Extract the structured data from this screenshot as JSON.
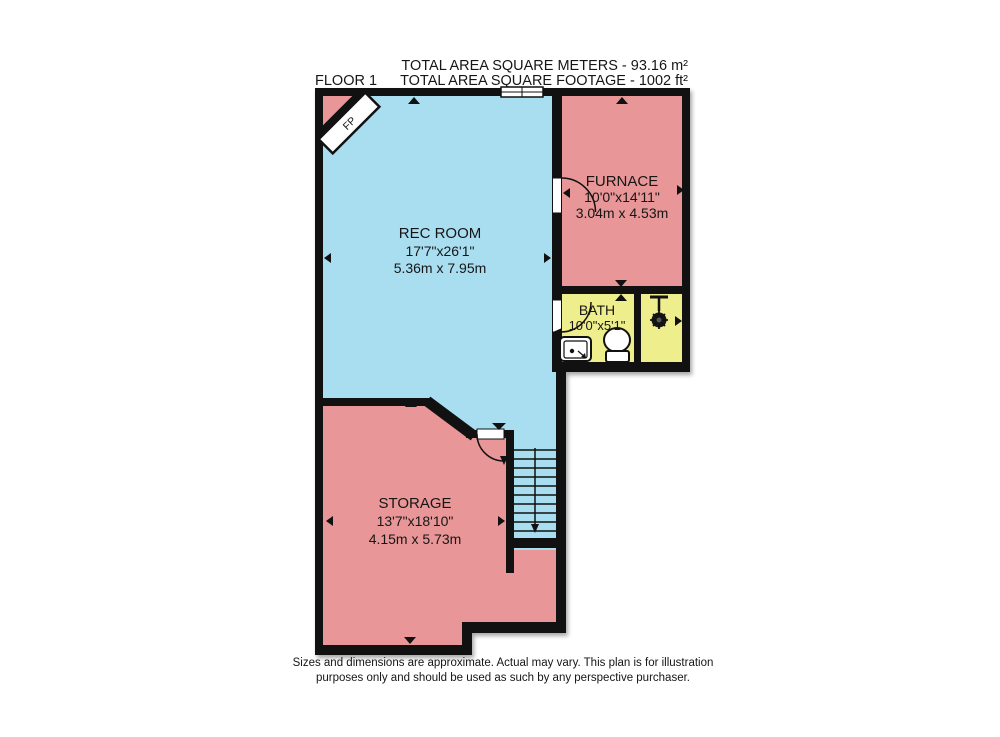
{
  "title": {
    "floor": "FLOOR 1",
    "area_line1": "TOTAL AREA SQUARE METERS - 93.16 m²",
    "area_line2": "TOTAL AREA SQUARE FOOTAGE - 1002 ft²"
  },
  "rooms": {
    "rec_room": {
      "name": "REC ROOM",
      "size_imperial": "17'7\"x26'1\"",
      "size_metric": "5.36m x 7.95m",
      "fill": "#a9def0"
    },
    "furnace": {
      "name": "FURNACE",
      "size_imperial": "10'0\"x14'11\"",
      "size_metric": "3.04m x 4.53m",
      "fill": "#e89697"
    },
    "bath": {
      "name": "BATH",
      "size_imperial": "10'0\"x5'1\"",
      "fill": "#efee8d"
    },
    "storage": {
      "name": "STORAGE",
      "size_imperial": "13'7\"x18'10\"",
      "size_metric": "4.15m x 5.73m",
      "fill": "#e89697"
    }
  },
  "annotations": {
    "fireplace": "FP"
  },
  "disclaimer": {
    "line1": "Sizes and dimensions are approximate. Actual may vary. This plan is for illustration",
    "line2": "purposes only and should be used as such by any perspective purchaser."
  },
  "colors": {
    "wall": "#111111",
    "rec_room_blue": "#a9def0",
    "room_pink": "#e89697",
    "bath_yellow": "#efee8d",
    "background": "#ffffff"
  }
}
